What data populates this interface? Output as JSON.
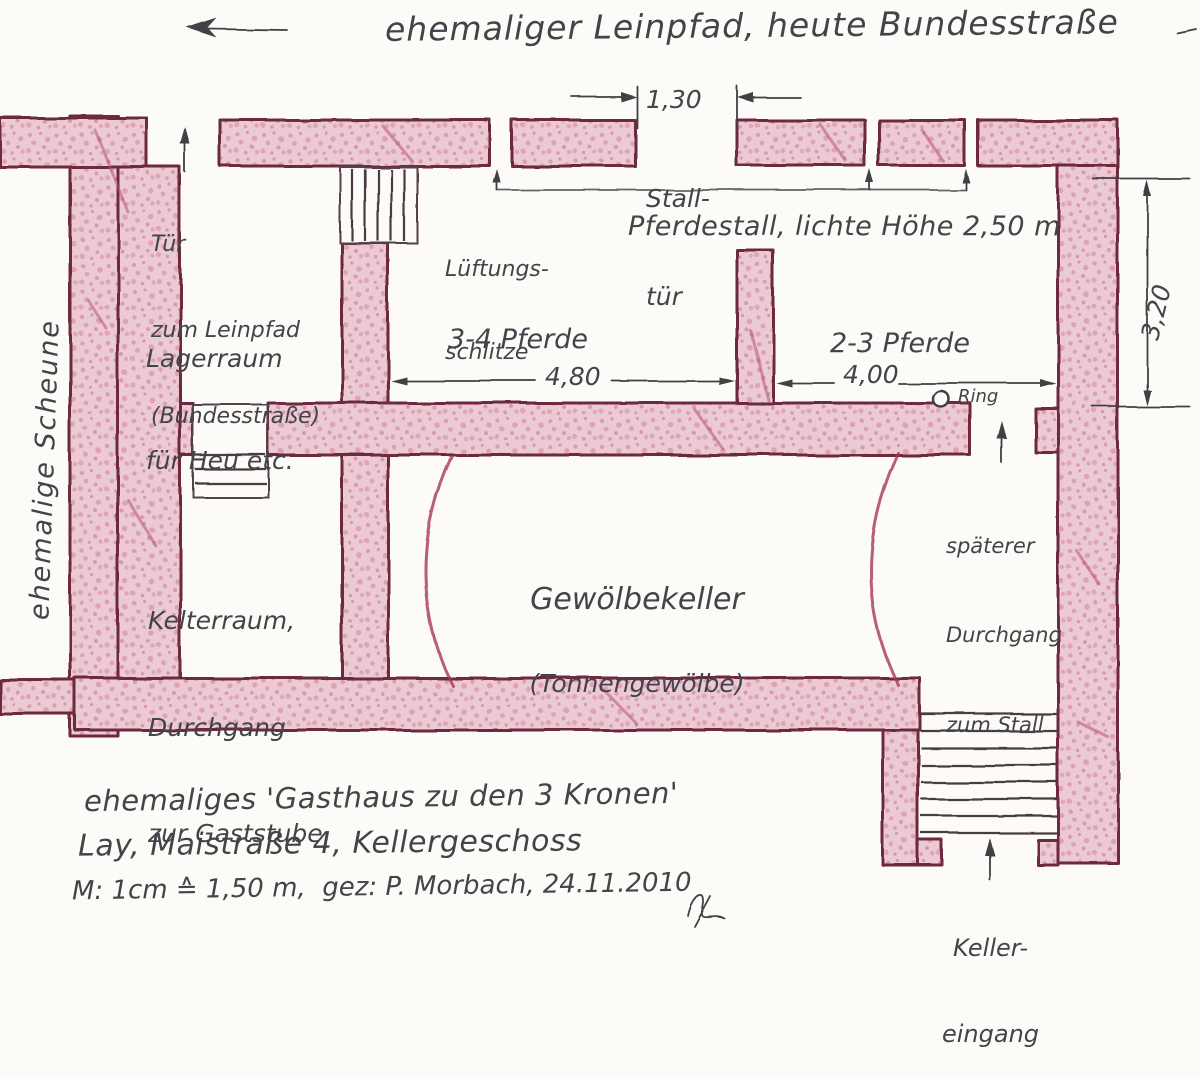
{
  "colors": {
    "paper": "#fcfbf7",
    "wall_fill": "#eccad4",
    "wall_speckle": "#c06088",
    "wall_outline": "#6d2c3e",
    "ink": "#3f3f45",
    "vault_line": "#a83750"
  },
  "road": {
    "label": "ehemaliger Leinpfad, heute Bundesstraße"
  },
  "doors": {
    "stall_door": {
      "line1": "Stall-",
      "line2": "tür"
    },
    "leinpfad_door": {
      "line1": "Tür",
      "line2": "zum Leinpfad",
      "line3": "(Bundesstraße)"
    },
    "stable_passage": {
      "line1": "späterer",
      "line2": "Durchgang",
      "line3": "zum Stall"
    },
    "cellar_entrance": {
      "line1": "Keller-",
      "line2": "eingang"
    }
  },
  "rooms": {
    "lagerraum": {
      "line1": "Lagerraum",
      "line2": "für Heu etc."
    },
    "pferdestall": {
      "label": "Pferdestall, lichte Höhe 2,50 m",
      "stall_left": "3-4 Pferde",
      "stall_right": "2-3 Pferde"
    },
    "kelterraum": {
      "line1": "Kelterraum,",
      "line2": "Durchgang",
      "line3": "zur Gaststube"
    },
    "gewoelbekeller": {
      "line1": "Gewölbekeller",
      "line2": "(Tonnengewölbe)"
    },
    "scheune": {
      "label": "ehemalige Scheune"
    }
  },
  "features": {
    "vent": {
      "line1": "Lüftungs-",
      "line2": "schlitze"
    },
    "ring": {
      "label": "Ring"
    }
  },
  "dimensions": {
    "stall_door_width": "1,30",
    "left_stall_width": "4,80",
    "right_stall_width": "4,00",
    "stable_depth": "3,20"
  },
  "footer": {
    "line1": "ehemaliges 'Gasthaus zu den 3 Kronen'",
    "line2": "Lay, Maistraße 4, Kellergeschoss",
    "line3": "M: 1cm ≙ 1,50 m,  gez: P. Morbach, 24.11.2010"
  }
}
